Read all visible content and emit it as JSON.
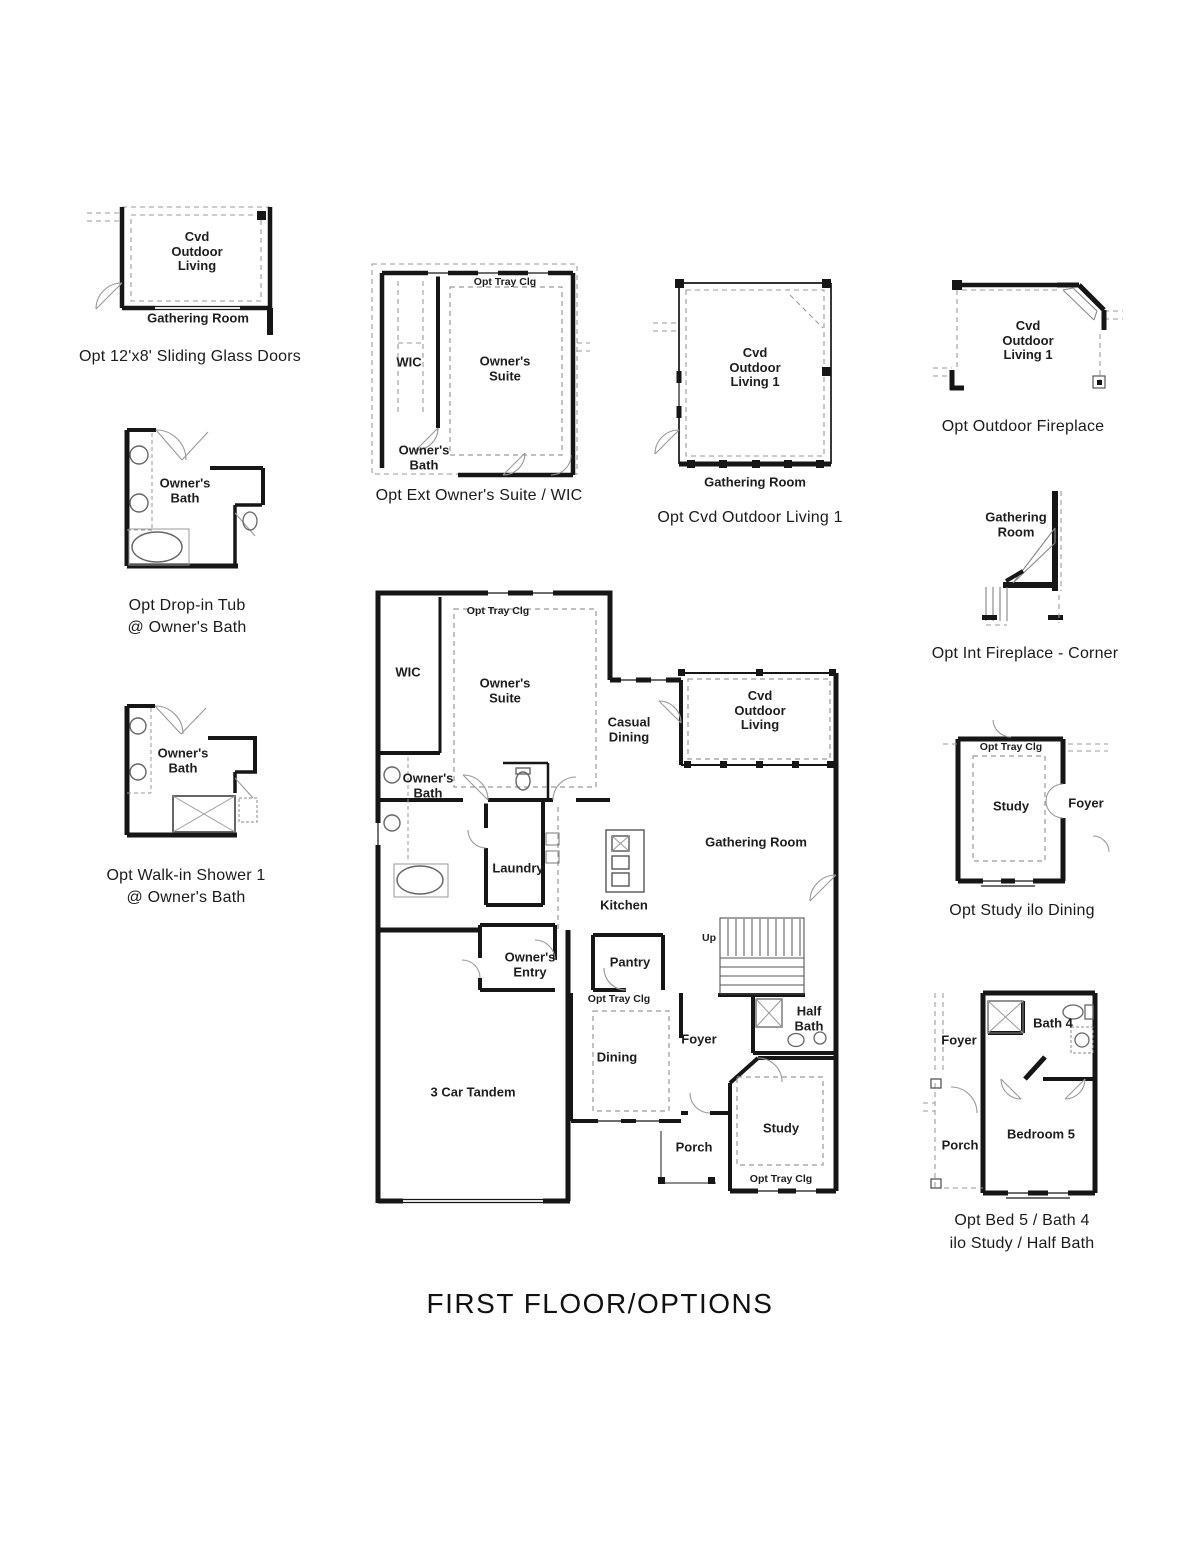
{
  "page": {
    "title": "FIRST FLOOR/OPTIONS"
  },
  "colors": {
    "wall": "#161616",
    "dashed": "#9a9a9a",
    "background": "#ffffff",
    "text": "#1c1c1c"
  },
  "main_plan": {
    "labels": {
      "tray_suite": "Opt Tray Clg",
      "wic": "WIC",
      "owners_suite": "Owner's Suite",
      "casual_dining": "Casual Dining",
      "cvd_outdoor_living": "Cvd Outdoor Living",
      "owners_bath": "Owner's Bath",
      "laundry": "Laundry",
      "kitchen": "Kitchen",
      "gathering_room": "Gathering Room",
      "owners_entry": "Owner's Entry",
      "pantry": "Pantry",
      "up": "Up",
      "tray_dining": "Opt Tray Clg",
      "half_bath": "Half Bath",
      "three_car_tandem": "3 Car Tandem",
      "dining": "Dining",
      "foyer": "Foyer",
      "study": "Study",
      "porch": "Porch",
      "tray_study": "Opt Tray Clg"
    }
  },
  "insets": {
    "sliding_glass_doors": {
      "caption": "Opt 12'x8' Sliding Glass Doors",
      "labels": {
        "room": "Cvd Outdoor Living",
        "adjacent": "Gathering Room"
      }
    },
    "ext_owners_suite": {
      "caption": "Opt Ext Owner's Suite / WIC",
      "labels": {
        "tray": "Opt Tray Clg",
        "wic": "WIC",
        "suite": "Owner's Suite",
        "bath": "Owner's Bath"
      }
    },
    "cvd_outdoor_living_1": {
      "caption": "Opt Cvd Outdoor Living 1",
      "labels": {
        "room": "Cvd Outdoor Living 1",
        "adjacent": "Gathering Room"
      }
    },
    "outdoor_fireplace": {
      "caption": "Opt Outdoor Fireplace",
      "labels": {
        "room": "Cvd Outdoor Living 1"
      }
    },
    "drop_in_tub": {
      "caption_line1": "Opt Drop-in Tub",
      "caption_line2": "@ Owner's Bath",
      "labels": {
        "room": "Owner's Bath"
      }
    },
    "int_fireplace_corner": {
      "caption": "Opt Int Fireplace - Corner",
      "labels": {
        "room": "Gathering Room"
      }
    },
    "walk_in_shower": {
      "caption_line1": "Opt Walk-in Shower 1",
      "caption_line2": "@ Owner's Bath",
      "labels": {
        "room": "Owner's Bath"
      }
    },
    "study_ilo_dining": {
      "caption": "Opt Study ilo Dining",
      "labels": {
        "tray": "Opt Tray Clg",
        "study": "Study",
        "foyer": "Foyer"
      }
    },
    "bed5_bath4": {
      "caption_line1": "Opt Bed 5 / Bath 4",
      "caption_line2": "ilo Study / Half Bath",
      "labels": {
        "foyer": "Foyer",
        "bath": "Bath 4",
        "bedroom": "Bedroom 5",
        "porch": "Porch"
      }
    }
  }
}
